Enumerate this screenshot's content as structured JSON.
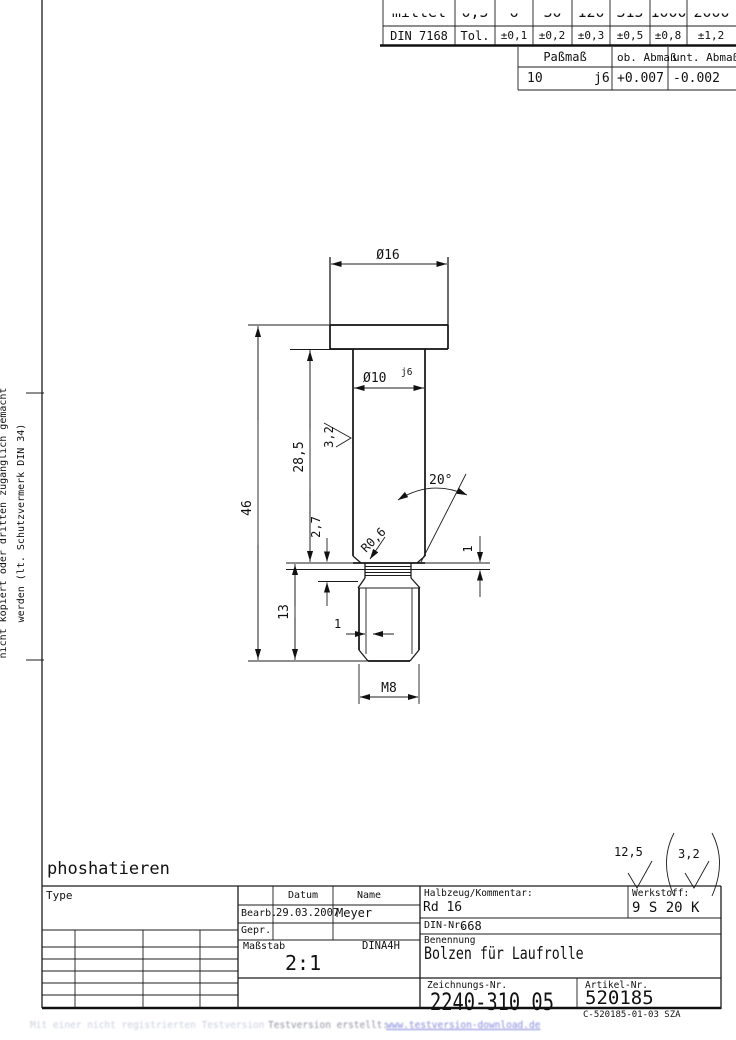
{
  "tol_table": {
    "clipped_row": [
      "mittel",
      "0,5",
      "6",
      "30",
      "120",
      "315",
      "1000",
      "2000"
    ],
    "standard": "DIN 7168",
    "tol_label": "Tol.",
    "tol_values": [
      "±0,1",
      "±0,2",
      "±0,3",
      "±0,5",
      "±0,8",
      "±1,2"
    ]
  },
  "fit_table": {
    "col_pass": "Paßmaß",
    "col_upper": "ob. Abmaß",
    "col_lower": "unt. Abmaß",
    "size": "10",
    "fit": "j6",
    "upper": "+0.007",
    "lower": "-0.002"
  },
  "side_note": {
    "line1": "nicht kopiert oder dritten zugänglich gemacht",
    "line2": "werden (lt. Schutzvermerk DIN 34)"
  },
  "drawing": {
    "dims": {
      "head_dia": "Ø16",
      "shaft_dia": "Ø10",
      "shaft_fit": "j6",
      "total_length": "46",
      "shaft_length": "28,5",
      "undercut_depth": "2,7",
      "thread_length": "13",
      "seat_angle": "20°",
      "fillet_radius": "R0,6",
      "thread": "M8",
      "runout_width": "1",
      "flange_height": "1",
      "shaft_roughness": "3,2"
    }
  },
  "finish": {
    "treatment": "phoshatieren",
    "general_roughness": "12,5",
    "fine_roughness": "3,2"
  },
  "title_block": {
    "type_label": "Type",
    "datum_label": "Datum",
    "name_label": "Name",
    "bearb_label": "Bearb.",
    "bearb_date": "29.03.2007",
    "bearb_name": "Meyer",
    "gepr_label": "Gepr.",
    "massstab_label": "Maßstab",
    "scale": "2:1",
    "format": "DINA4H",
    "halbzeug_label": "Halbzeug/Kommentar:",
    "halbzeug": "Rd 16",
    "werkstoff_label": "Werkstoff:",
    "werkstoff": "9 S 20 K",
    "din_label": "DIN-Nr.",
    "din_nr": "668",
    "benennung_label": "Benennung",
    "benennung": "Bolzen für Laufrolle",
    "zeichnung_label": "Zeichnungs-Nr.",
    "zeichnung_nr": "2240-310 05",
    "artikel_label": "Artikel-Nr.",
    "artikel_nr": "520185",
    "doc_code": "C-520185-01-03 SZA"
  },
  "watermark": {
    "left": "Mit einer nicht registrierten Testversion",
    "mid": "Testversion erstellt:",
    "link": "www.testversion-download.de"
  }
}
